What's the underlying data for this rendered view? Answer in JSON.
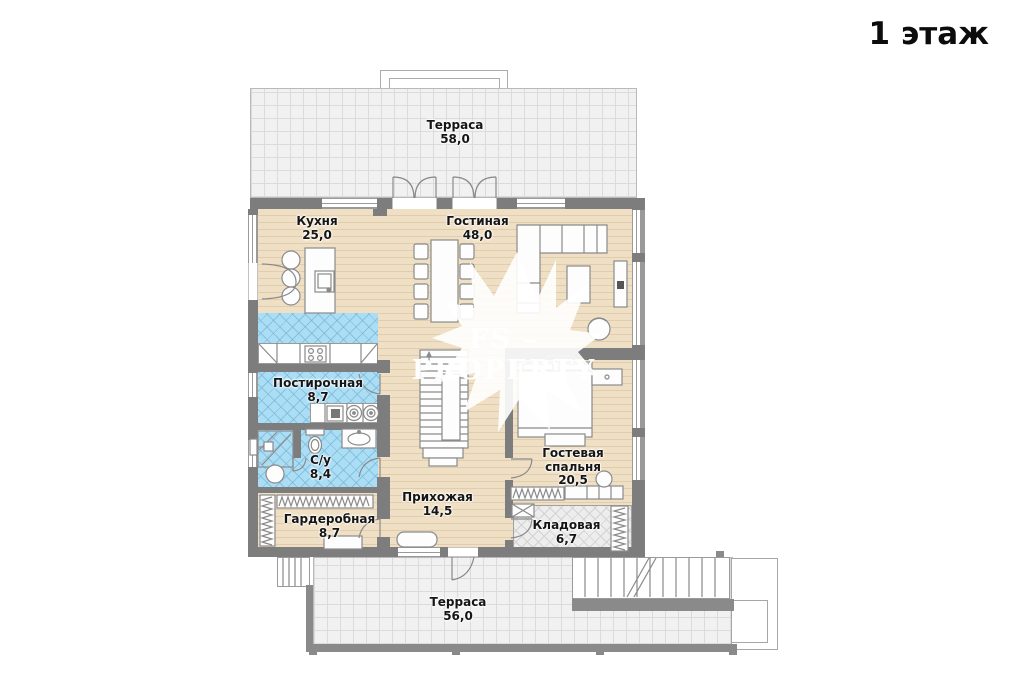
{
  "title": "1 этаж",
  "watermark": "FS – PROPERTY",
  "rooms": [
    {
      "id": "terrace-top",
      "name": "Терраса",
      "area": "58,0"
    },
    {
      "id": "kitchen",
      "name": "Кухня",
      "area": "25,0"
    },
    {
      "id": "living-room",
      "name": "Гостиная",
      "area": "48,0"
    },
    {
      "id": "laundry",
      "name": "Постирочная",
      "area": "8,7"
    },
    {
      "id": "bathroom",
      "name": "С/у",
      "area": "8,4"
    },
    {
      "id": "guest-bedroom",
      "name": "Гостевая спальня",
      "area": "20,5"
    },
    {
      "id": "hallway",
      "name": "Прихожая",
      "area": "14,5"
    },
    {
      "id": "wardrobe",
      "name": "Гардеробная",
      "area": "8,7"
    },
    {
      "id": "storage",
      "name": "Кладовая",
      "area": "6,7"
    },
    {
      "id": "terrace-bottom",
      "name": "Терраса",
      "area": "56,0"
    }
  ],
  "colors": {
    "wall": "#7d7d7d",
    "wood_floor": "#efdfc4",
    "tile_blue": "#abdef5",
    "terrace_tile": "#f1f1f1",
    "storage_tile": "#ededed",
    "label_text": "#151515",
    "watermark_text": "#ffffff"
  }
}
